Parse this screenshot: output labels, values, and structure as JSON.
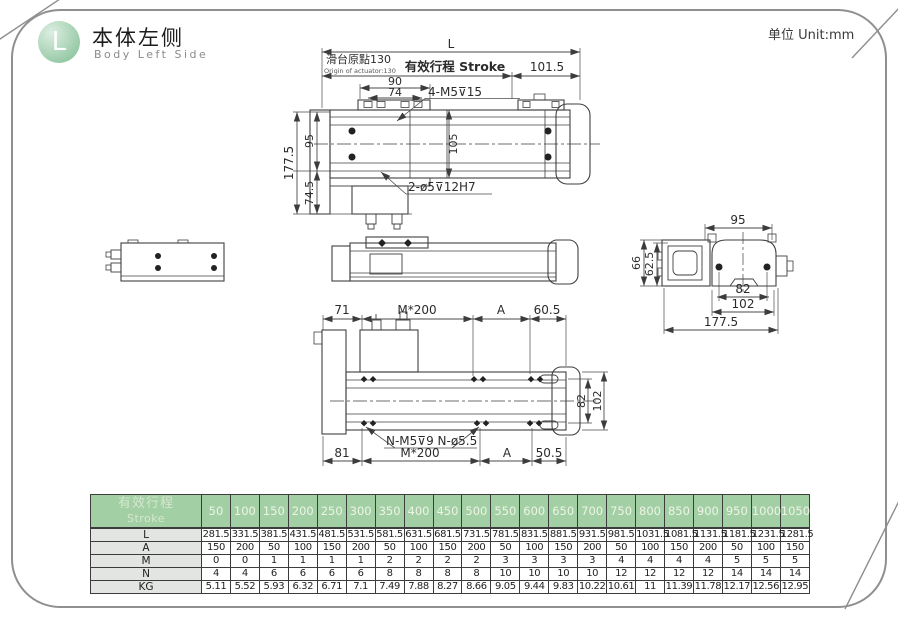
{
  "header": {
    "badge_letter": "L",
    "title_cn": "本体左侧",
    "title_en": "Body Left Side",
    "unit": "单位 Unit:mm"
  },
  "top_view": {
    "overall_length": "L",
    "origin_cn": "滑台原點130",
    "origin_en": "Origin of actuator:130",
    "stroke_label": "有效行程 Stroke",
    "right_offset": "101.5",
    "carriage_outer": "90",
    "carriage_inner": "74",
    "holes_callout": "4-M5⊽15",
    "rail_width": "105",
    "height_total": "177.5",
    "height_upper": "95",
    "height_lower": "74.5",
    "pin_callout": "2-ø5⊽12H7"
  },
  "end_view": {
    "top_width": "95",
    "height_total": "66",
    "height_inner": "62.5",
    "slot_width": "82",
    "base_width": "102",
    "overall_width": "177.5"
  },
  "bottom_view": {
    "top_left": "71",
    "top_pitch": "M*200",
    "top_a": "A",
    "top_right": "60.5",
    "bottom_left": "81",
    "bottom_pitch": "M*200",
    "bottom_a": "A",
    "bottom_right": "50.5",
    "right_inner": "82",
    "right_outer": "102",
    "holes_callout": "N-M5⊽9 N-ø5.5"
  },
  "table": {
    "row_header_cn": "有效行程",
    "row_header_en": "Stroke",
    "strokes": [
      "50",
      "100",
      "150",
      "200",
      "250",
      "300",
      "350",
      "400",
      "450",
      "500",
      "550",
      "600",
      "650",
      "700",
      "750",
      "800",
      "850",
      "900",
      "950",
      "1000",
      "1050"
    ],
    "rows": [
      {
        "label": "L",
        "values": [
          "281.5",
          "331.5",
          "381.5",
          "431.5",
          "481.5",
          "531.5",
          "581.5",
          "631.5",
          "681.5",
          "731.5",
          "781.5",
          "831.5",
          "881.5",
          "931.5",
          "981.5",
          "1031.5",
          "1081.5",
          "1131.5",
          "1181.5",
          "1231.5",
          "1281.5"
        ]
      },
      {
        "label": "A",
        "values": [
          "150",
          "200",
          "50",
          "100",
          "150",
          "200",
          "50",
          "100",
          "150",
          "200",
          "50",
          "100",
          "150",
          "200",
          "50",
          "100",
          "150",
          "200",
          "50",
          "100",
          "150"
        ]
      },
      {
        "label": "M",
        "values": [
          "0",
          "0",
          "1",
          "1",
          "1",
          "1",
          "2",
          "2",
          "2",
          "2",
          "3",
          "3",
          "3",
          "3",
          "4",
          "4",
          "4",
          "4",
          "5",
          "5",
          "5"
        ]
      },
      {
        "label": "N",
        "values": [
          "4",
          "4",
          "6",
          "6",
          "6",
          "6",
          "8",
          "8",
          "8",
          "8",
          "10",
          "10",
          "10",
          "10",
          "12",
          "12",
          "12",
          "12",
          "14",
          "14",
          "14"
        ]
      },
      {
        "label": "KG",
        "values": [
          "5.11",
          "5.52",
          "5.93",
          "6.32",
          "6.71",
          "7.1",
          "7.49",
          "7.88",
          "8.27",
          "8.66",
          "9.05",
          "9.44",
          "9.83",
          "10.22",
          "10.61",
          "11",
          "11.39",
          "11.78",
          "12.17",
          "12.56",
          "12.95"
        ]
      }
    ]
  }
}
